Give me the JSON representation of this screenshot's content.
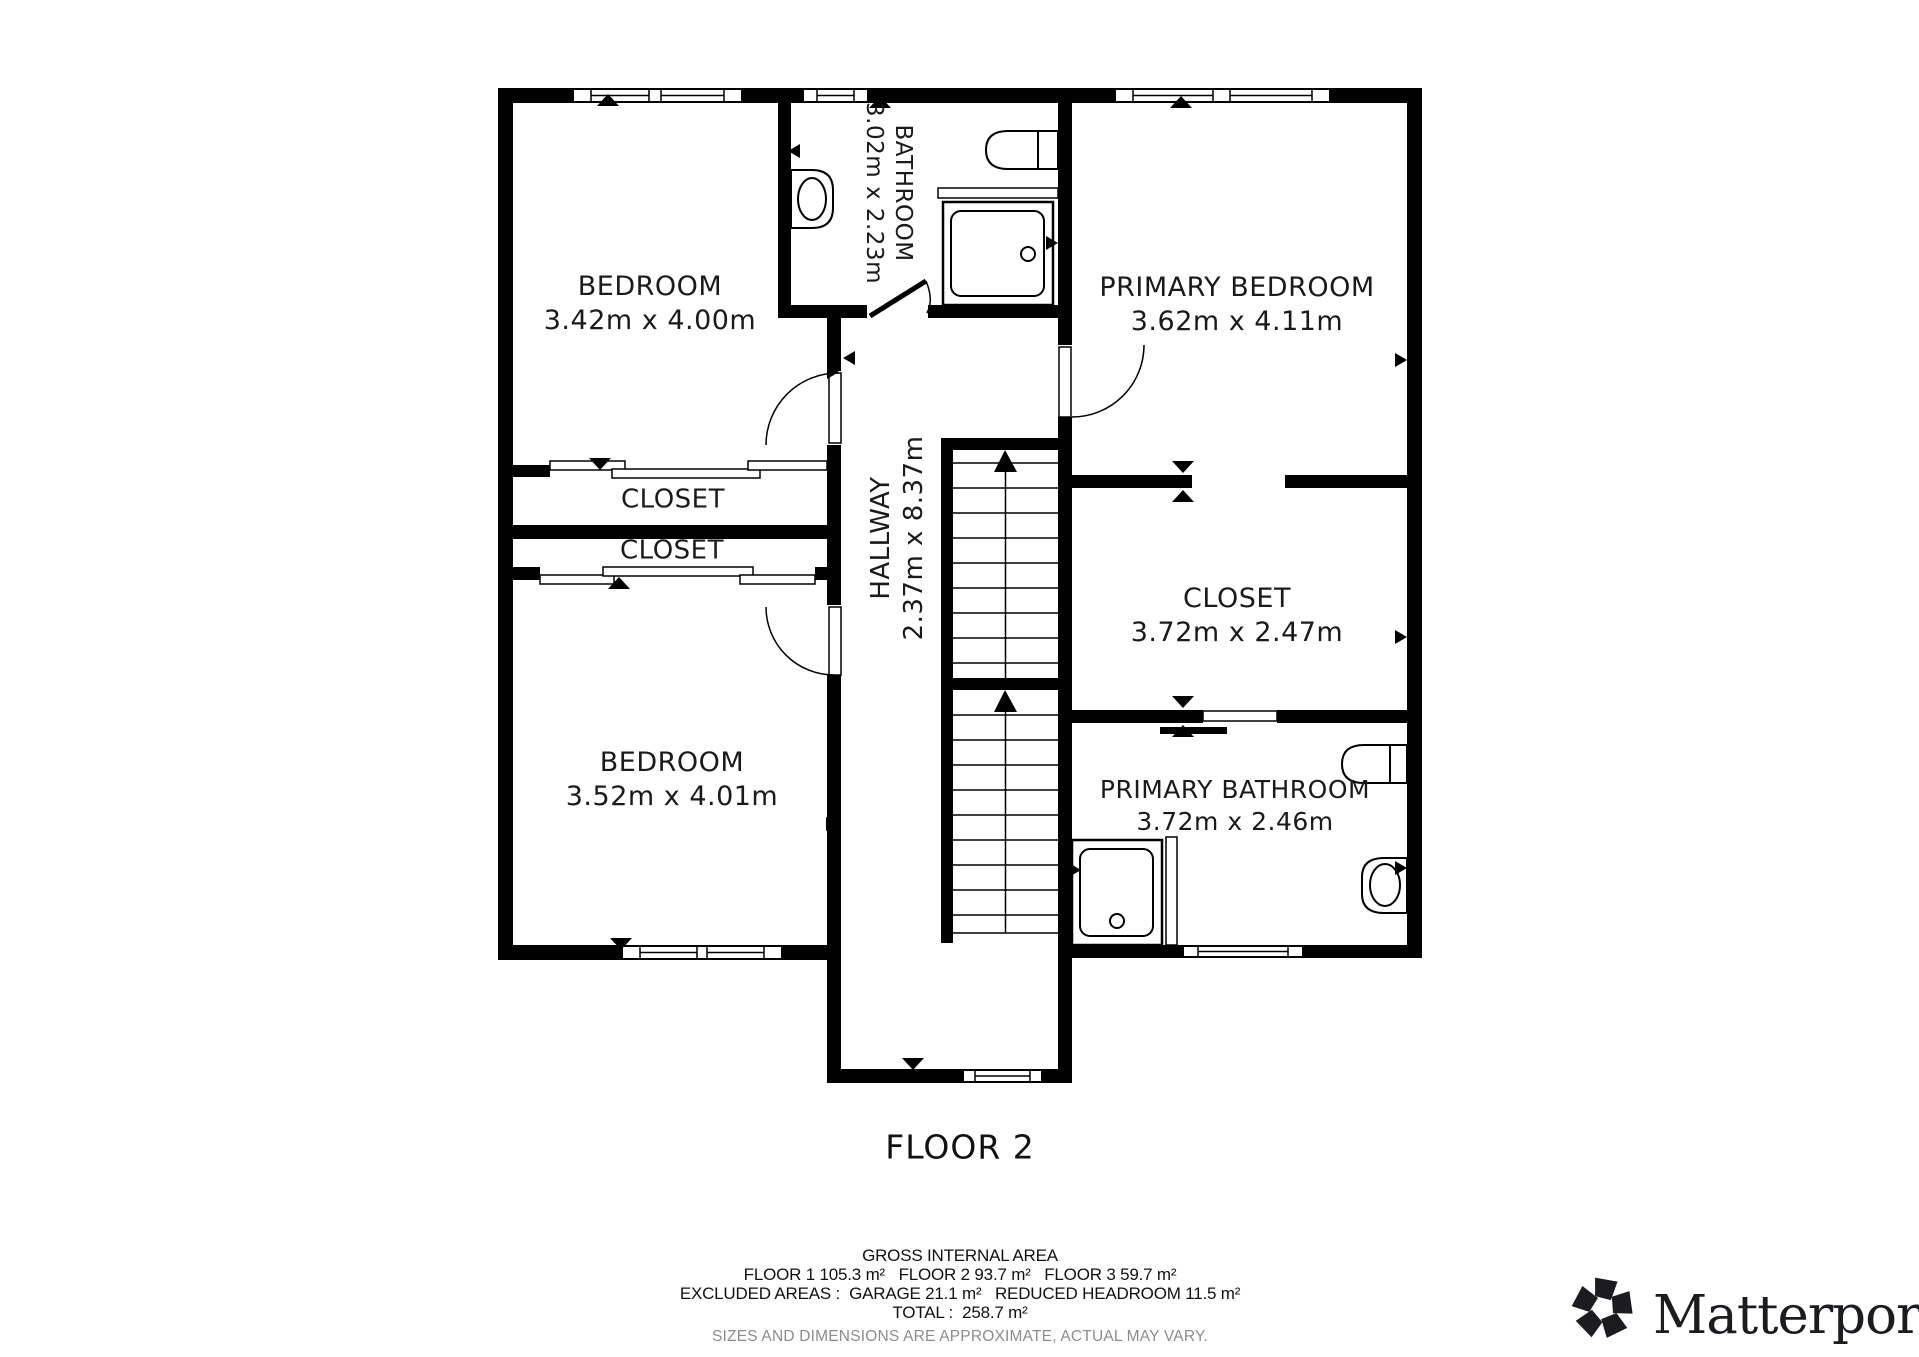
{
  "plan": {
    "title": "FLOOR 2",
    "rooms": {
      "bedroom_top": {
        "name": "BEDROOM",
        "dims": "3.42m x 4.00m"
      },
      "bathroom": {
        "name": "BATHROOM",
        "dims": "3.02m x 2.23m"
      },
      "primary_bedroom": {
        "name": "PRIMARY BEDROOM",
        "dims": "3.62m x 4.11m"
      },
      "hallway": {
        "name": "HALLWAY",
        "dims": "2.37m x 8.37m"
      },
      "closet_upper": {
        "name": "CLOSET"
      },
      "closet_lower": {
        "name": "CLOSET"
      },
      "closet_right": {
        "name": "CLOSET",
        "dims": "3.72m x 2.47m"
      },
      "bedroom_bottom": {
        "name": "BEDROOM",
        "dims": "3.52m x 4.01m"
      },
      "primary_bathroom": {
        "name": "PRIMARY BATHROOM",
        "dims": "3.72m x 2.46m"
      }
    }
  },
  "footer": {
    "title": "GROSS INTERNAL AREA",
    "line_floors": "FLOOR 1 105.3 m²   FLOOR 2 93.7 m²   FLOOR 3 59.7 m²",
    "line_excluded": "EXCLUDED AREAS :  GARAGE 21.1 m²   REDUCED HEADROOM 11.5 m²",
    "line_total": "TOTAL :  258.7 m²",
    "disclaimer": "SIZES AND DIMENSIONS ARE APPROXIMATE, ACTUAL MAY VARY."
  },
  "branding": {
    "name": "Matterport",
    "registered": "®"
  },
  "colors": {
    "wall": "#000000",
    "background": "#ffffff",
    "text": "#1a1a1a",
    "muted": "#8c8c8c"
  }
}
